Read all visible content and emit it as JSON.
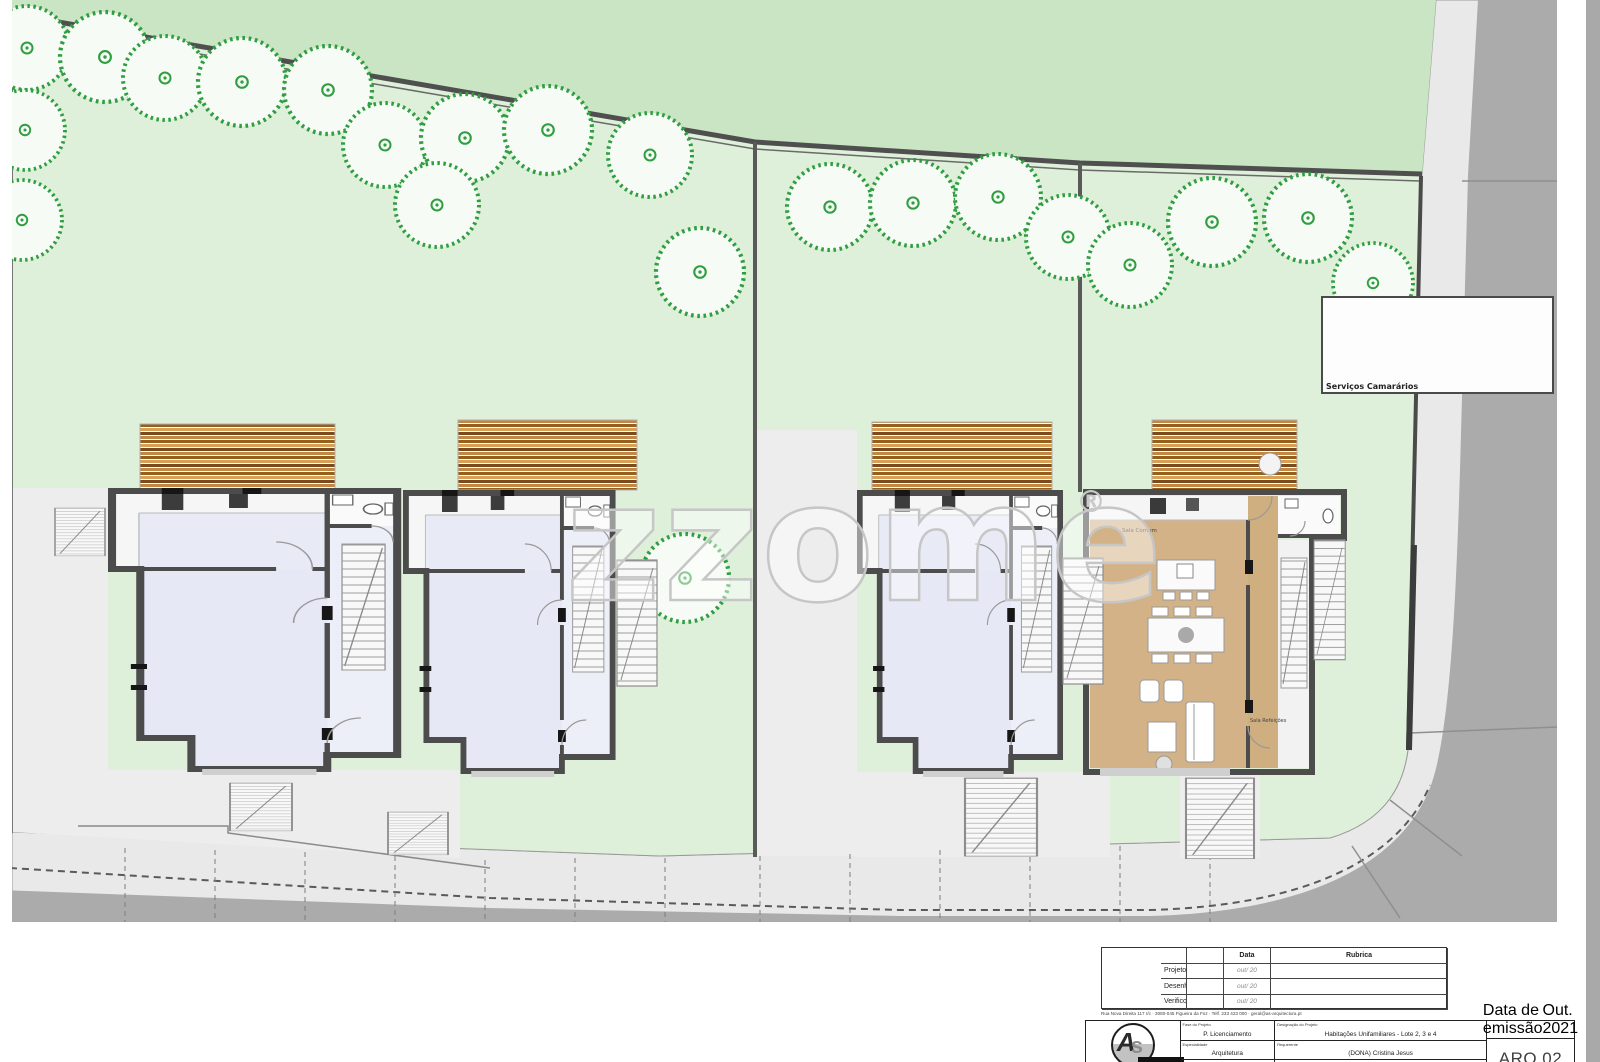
{
  "watermark": {
    "text": "zzome",
    "registered": "®"
  },
  "site": {
    "callout_label": "Serviços Camarários"
  },
  "house4": {
    "label_living": "Sala Comum",
    "label_dining": "Sala Refeições"
  },
  "colors": {
    "outer_green": "#c9e5c4",
    "plot_green": "#dff0da",
    "tree_green": "#2f9e41",
    "wall_gray": "#4c4c4c",
    "floor_lavender": "#e6e8f5",
    "wood_tan": "#d4b287",
    "sidewalk": "#e9e9e9",
    "road": "#ababab"
  },
  "trees": [
    {
      "x": 27,
      "y": 48,
      "r": 42
    },
    {
      "x": 105,
      "y": 57,
      "r": 45
    },
    {
      "x": 165,
      "y": 78,
      "r": 42
    },
    {
      "x": 242,
      "y": 82,
      "r": 44
    },
    {
      "x": 328,
      "y": 90,
      "r": 44
    },
    {
      "x": 25,
      "y": 130,
      "r": 40
    },
    {
      "x": 22,
      "y": 220,
      "r": 40
    },
    {
      "x": 385,
      "y": 145,
      "r": 42
    },
    {
      "x": 465,
      "y": 138,
      "r": 44
    },
    {
      "x": 437,
      "y": 205,
      "r": 42
    },
    {
      "x": 548,
      "y": 130,
      "r": 44
    },
    {
      "x": 650,
      "y": 155,
      "r": 42
    },
    {
      "x": 700,
      "y": 272,
      "r": 44
    },
    {
      "x": 830,
      "y": 207,
      "r": 43
    },
    {
      "x": 913,
      "y": 203,
      "r": 43
    },
    {
      "x": 998,
      "y": 197,
      "r": 43
    },
    {
      "x": 1068,
      "y": 237,
      "r": 42
    },
    {
      "x": 1130,
      "y": 265,
      "r": 42
    },
    {
      "x": 1212,
      "y": 222,
      "r": 44
    },
    {
      "x": 1308,
      "y": 218,
      "r": 44
    },
    {
      "x": 1373,
      "y": 283,
      "r": 40
    },
    {
      "x": 685,
      "y": 578,
      "r": 44
    }
  ],
  "titleblock": {
    "sign_table": {
      "data_header": "Data",
      "rubrica_header": "Rubrica",
      "rows": [
        {
          "label": "Projetou:",
          "data": "out/ 20",
          "rubrica": ""
        },
        {
          "label": "Desenhou:",
          "data": "out/ 20",
          "rubrica": ""
        },
        {
          "label": "Verificou:",
          "data": "out/ 20",
          "rubrica": ""
        }
      ]
    },
    "address_line": "Rua Nova Direita 117 r/c · 3080-045 Figueira da Foz · Telf. 233 423 000 · geral@as-arquitectura.pt",
    "logo_text_a": "A",
    "logo_text_s": "s",
    "info": {
      "col2": [
        {
          "header": "Fase do Projeto",
          "value": "P. Licenciamento"
        },
        {
          "header": "Especialidade",
          "value": "Arquitetura"
        },
        {
          "header": "Autor do Projeto",
          "value": "arq. Andreia Matias"
        }
      ],
      "col3": [
        {
          "header": "Designação do Projeto",
          "value": "Habitações Unifamiliares - Lote 2, 3 e 4"
        },
        {
          "header": "Requerente",
          "value": "(DONA) Cristina Jesus"
        },
        {
          "header": "Local da Obra",
          "value": "Lugar N. Vila Cid Dtal CPPT"
        }
      ],
      "date_header": "Data de emissão",
      "date": "Out. 2021",
      "sheet": "ARQ.02"
    }
  }
}
